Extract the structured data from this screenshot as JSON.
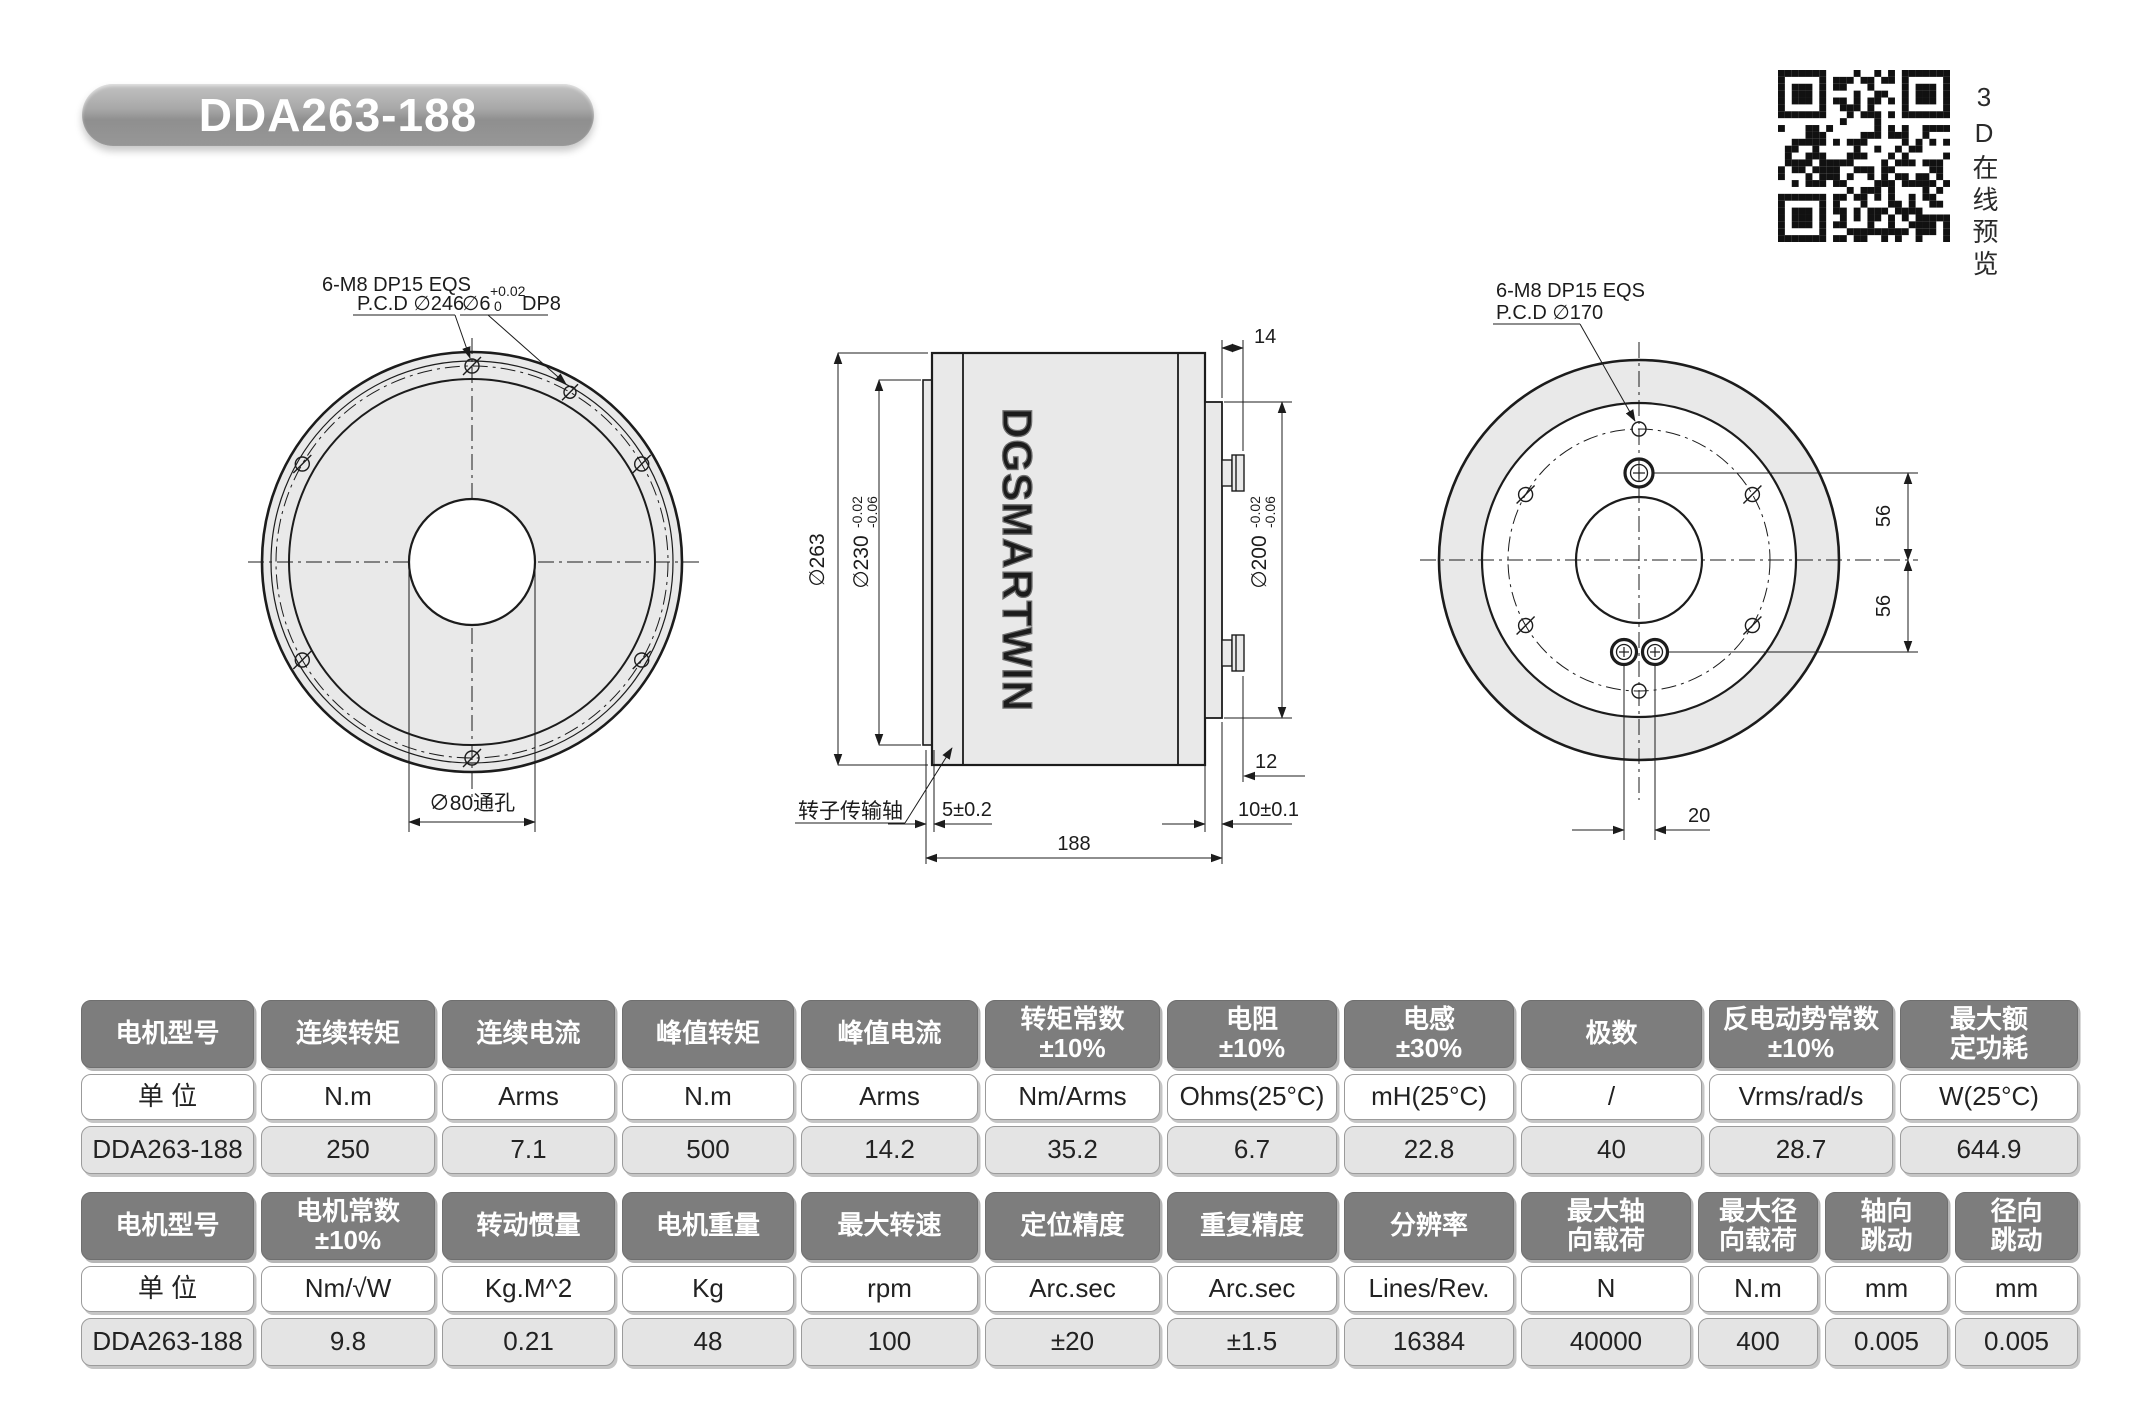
{
  "title_badge": "DDA263-188",
  "qr": {
    "caption": "3D在线预览"
  },
  "colors": {
    "table_header_bg": "#7d7d7d",
    "table_value_bg": "#e4e4e4",
    "drawing_fill": "#e9e9e9",
    "line": "#1c1c1c"
  },
  "front_view": {
    "bolt_label_line1": "6-M8  DP15  EQS",
    "bolt_label_line2": "P.C.D ∅246",
    "pin_label_dia": "∅6",
    "pin_label_tol_upper": "+0.02",
    "pin_label_tol_lower": "0",
    "pin_label_depth": "DP8",
    "center_hole_label": "∅80通孔"
  },
  "side_view": {
    "logo": "DGSMARTWIN",
    "dia_outer": "∅263",
    "dia_mid": "∅230",
    "dia_mid_tol_up": "-0.02",
    "dia_mid_tol_low": "-0.06",
    "dia_right": "∅200",
    "dia_right_tol_up": "-0.02",
    "dia_right_tol_low": "-0.06",
    "dim_gland_depth": "14",
    "dim_plate_step": "12",
    "dim_plate_thickness": "10±0.1",
    "dim_flange_thickness": "5±0.2",
    "dim_total_length": "188",
    "shaft_label": "转子传输轴"
  },
  "rear_view": {
    "bolt_label_line1": "6-M8 DP15 EQS",
    "bolt_label_line2": "P.C.D ∅170",
    "dim_conn_upper": "56",
    "dim_conn_lower": "56",
    "dim_conn_spacing": "20"
  },
  "spec_table_1": {
    "columns": [
      {
        "header": "电机型号",
        "unit": "单 位",
        "value": "DDA263-188"
      },
      {
        "header": "连续转矩",
        "unit": "N.m",
        "value": "250"
      },
      {
        "header": "连续电流",
        "unit": "Arms",
        "value": "7.1"
      },
      {
        "header": "峰值转矩",
        "unit": "N.m",
        "value": "500"
      },
      {
        "header": "峰值电流",
        "unit": "Arms",
        "value": "14.2"
      },
      {
        "header": "转矩常数\n±10%",
        "unit": "Nm/Arms",
        "value": "35.2"
      },
      {
        "header": "电阻\n±10%",
        "unit": "Ohms(25°C)",
        "value": "6.7"
      },
      {
        "header": "电感\n±30%",
        "unit": "mH(25°C)",
        "value": "22.8"
      },
      {
        "header": "极数",
        "unit": "/",
        "value": "40"
      },
      {
        "header": "反电动势常数\n±10%",
        "unit": "Vrms/rad/s",
        "value": "28.7"
      },
      {
        "header": "最大额\n定功耗",
        "unit": "W(25°C)",
        "value": "644.9"
      }
    ]
  },
  "spec_table_2": {
    "columns": [
      {
        "header": "电机型号",
        "unit": "单 位",
        "value": "DDA263-188"
      },
      {
        "header": "电机常数\n±10%",
        "unit": "Nm/√W",
        "value": "9.8"
      },
      {
        "header": "转动惯量",
        "unit": "Kg.M^2",
        "value": "0.21"
      },
      {
        "header": "电机重量",
        "unit": "Kg",
        "value": "48"
      },
      {
        "header": "最大转速",
        "unit": "rpm",
        "value": "100"
      },
      {
        "header": "定位精度",
        "unit": "Arc.sec",
        "value": "±20"
      },
      {
        "header": "重复精度",
        "unit": "Arc.sec",
        "value": "±1.5"
      },
      {
        "header": "分辨率",
        "unit": "Lines/Rev.",
        "value": "16384"
      },
      {
        "header": "最大轴\n向载荷",
        "unit": "N",
        "value": "40000"
      },
      {
        "header": "最大径\n向载荷",
        "unit": "N.m",
        "value": "400"
      },
      {
        "header": "轴向\n跳动",
        "unit": "mm",
        "value": "0.005"
      },
      {
        "header": "径向\n跳动",
        "unit": "mm",
        "value": "0.005"
      }
    ]
  }
}
